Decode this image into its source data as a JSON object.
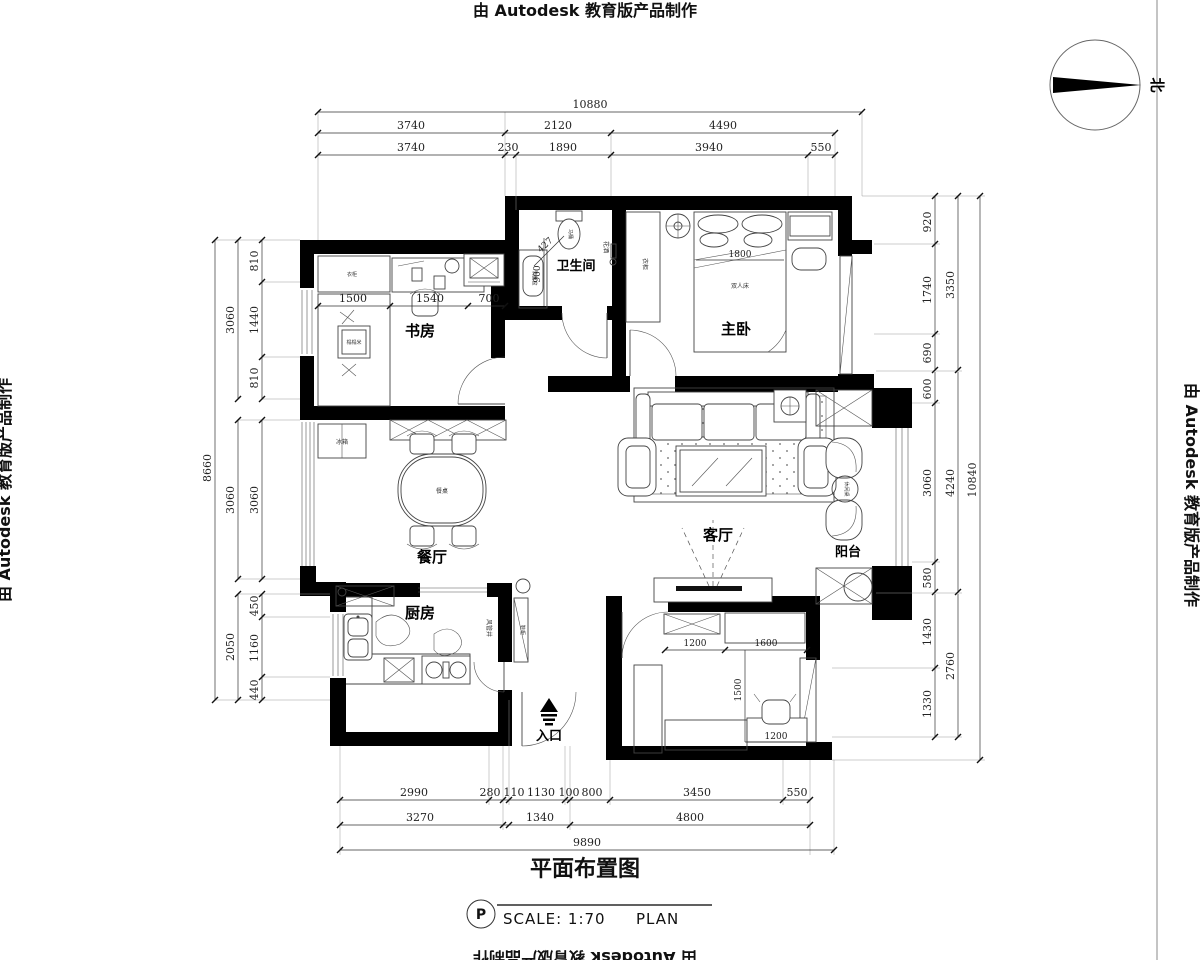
{
  "watermark": {
    "text": "由 Autodesk 教育版产品制作"
  },
  "north": {
    "label": "北"
  },
  "title_block": {
    "title": "平面布置图",
    "p": "P",
    "scale": "SCALE: 1:70",
    "plan": "PLAN"
  },
  "rooms": {
    "study": "书房",
    "bathroom": "卫生间",
    "master": "主卧",
    "dining": "餐厅",
    "living": "客厅",
    "balcony": "阳台",
    "kitchen": "厨房",
    "entrance": "入口"
  },
  "furniture": {
    "toilet": "马桶",
    "shower": "花洒",
    "basin": "洗面盆",
    "wardrobe": "衣柜",
    "double_bed": "双人床",
    "bed_width": "1800",
    "tatami": "榻榻米",
    "fridge": "冰箱",
    "dining_table": "餐桌",
    "leisure_table": "休闲桌",
    "duct": "风管井",
    "shoe_cabinet": "鞋柜"
  },
  "dims": {
    "top": {
      "overall": "10880",
      "row2": [
        "3740",
        "2120",
        "4490"
      ],
      "row3": [
        "3740",
        "230",
        "1890",
        "3940",
        "550"
      ]
    },
    "left": {
      "overall": "8660",
      "mid": [
        "3060",
        "3060",
        "2050"
      ],
      "inner": [
        "810",
        "1440",
        "810",
        "3060",
        "450",
        "1160",
        "440"
      ]
    },
    "right": {
      "overall": "10840",
      "mid": [
        "3350",
        "4240",
        "2760"
      ],
      "inner": [
        "920",
        "1740",
        "690",
        "600",
        "3060",
        "580",
        "1430",
        "1330"
      ]
    },
    "bottom": {
      "overall": "9890",
      "row1": [
        "2990",
        "280",
        "110",
        "1130",
        "100",
        "800",
        "3450",
        "550"
      ],
      "row2": [
        "3270",
        "1340",
        "4800"
      ]
    },
    "study": [
      "1500",
      "1540",
      "700"
    ],
    "bath": [
      "427",
      "900"
    ],
    "bedroom2": [
      "1200",
      "1600",
      "1500",
      "1200"
    ]
  }
}
